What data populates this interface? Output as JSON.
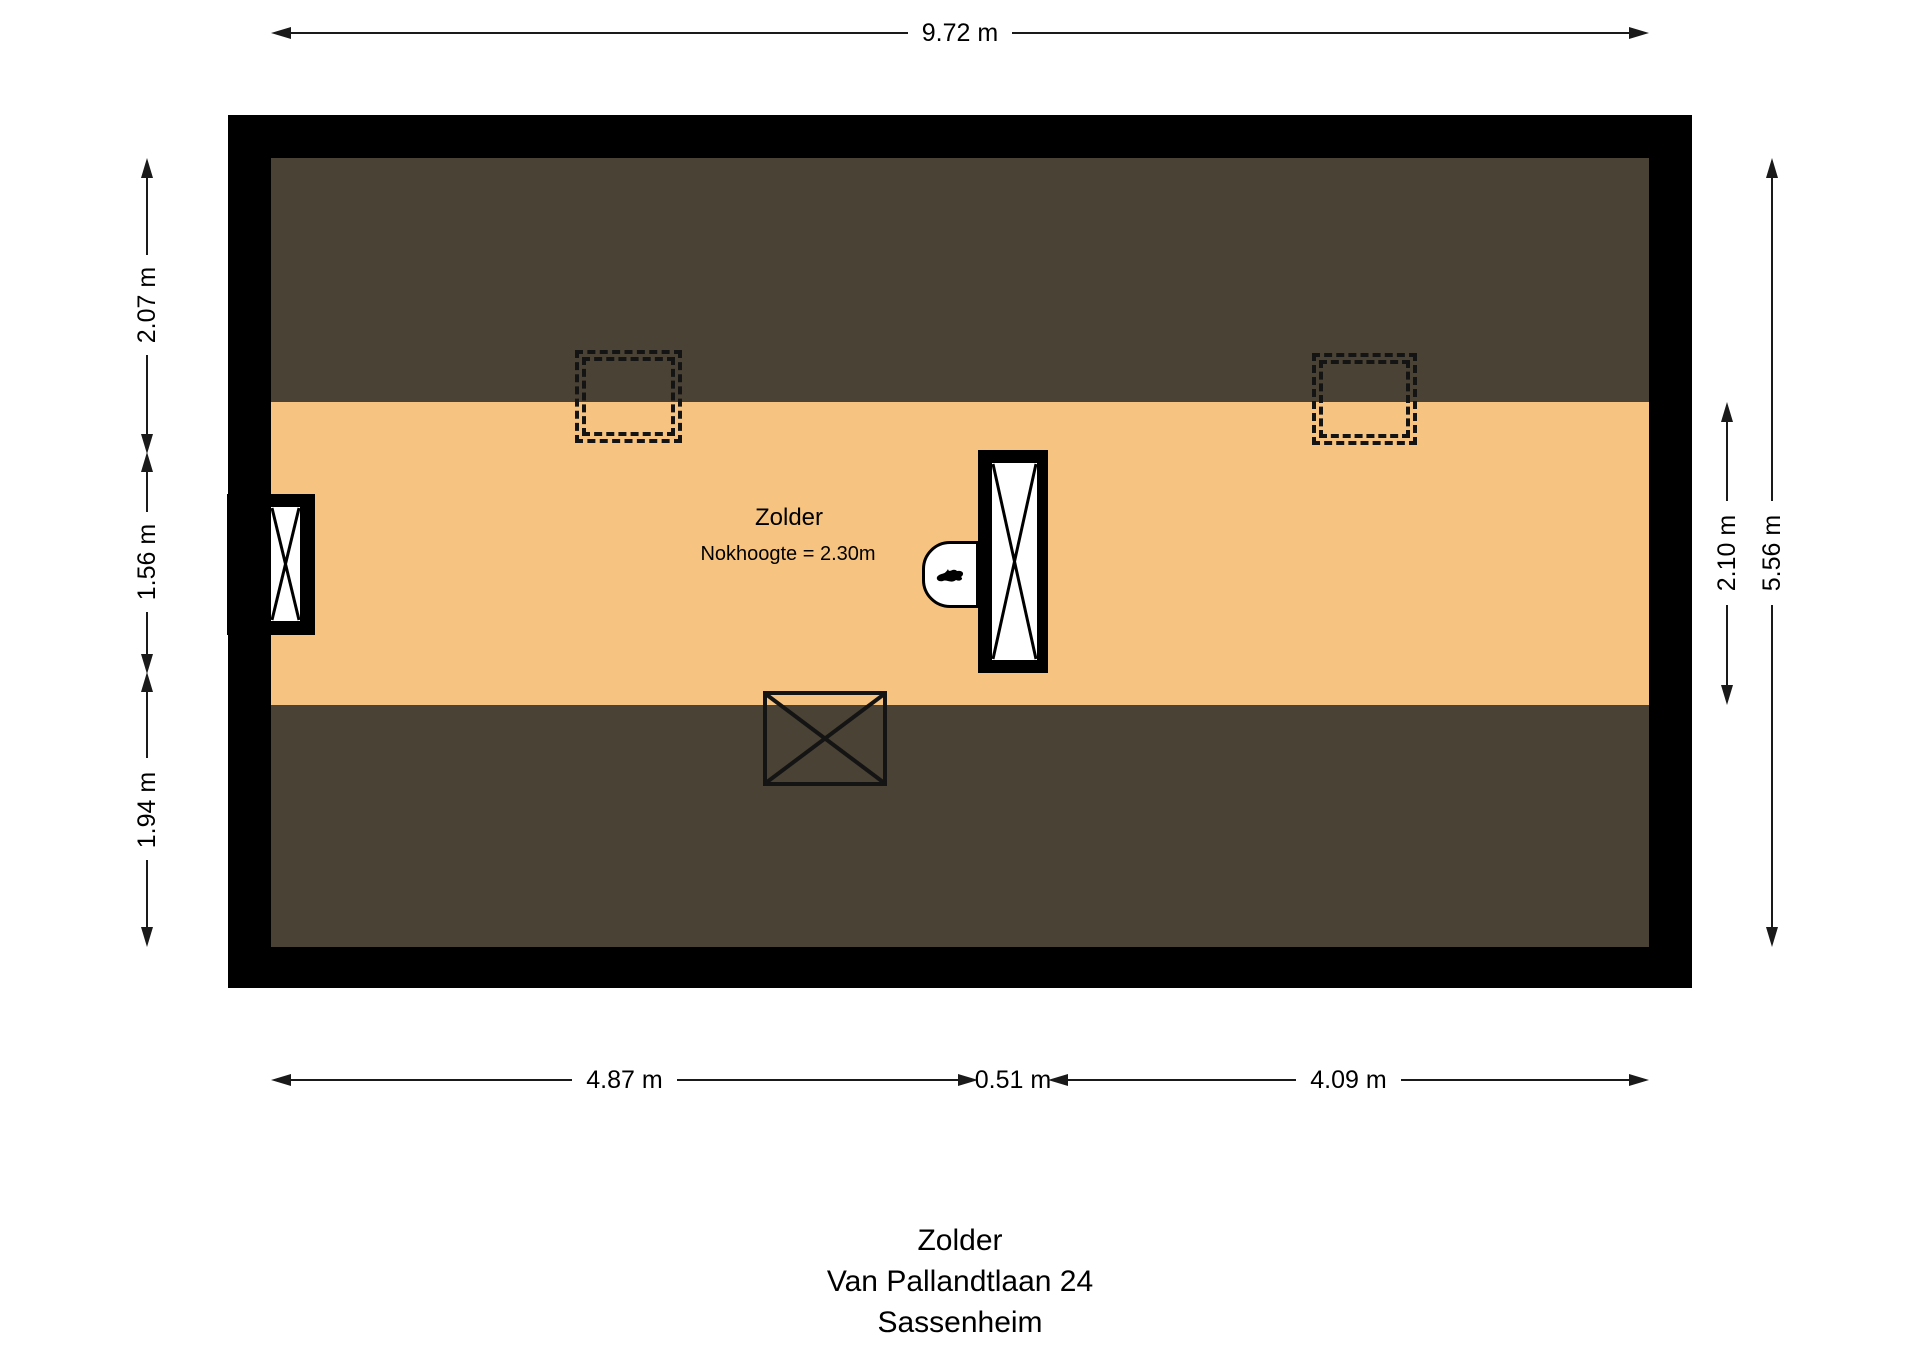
{
  "plan": {
    "room_label": "Zolder",
    "ridge_height_label": "Nokhoogte = 2.30m",
    "colors": {
      "wall": "#000000",
      "sloped_ceiling": "#4a4234",
      "floor": "#f6c480",
      "dimension_line": "#1a1a1a",
      "background": "#ffffff"
    }
  },
  "dimensions": {
    "top_width": "9.72 m",
    "left_segments": [
      "2.07 m",
      "1.56 m",
      "1.94 m"
    ],
    "right_floor_height": "2.10 m",
    "right_total_height": "5.56 m",
    "bottom_segments": [
      "4.87 m",
      "0.51 m",
      "4.09 m"
    ]
  },
  "footer": {
    "line1": "Zolder",
    "line2": "Van Pallandtlaan 24",
    "line3": "Sassenheim"
  }
}
